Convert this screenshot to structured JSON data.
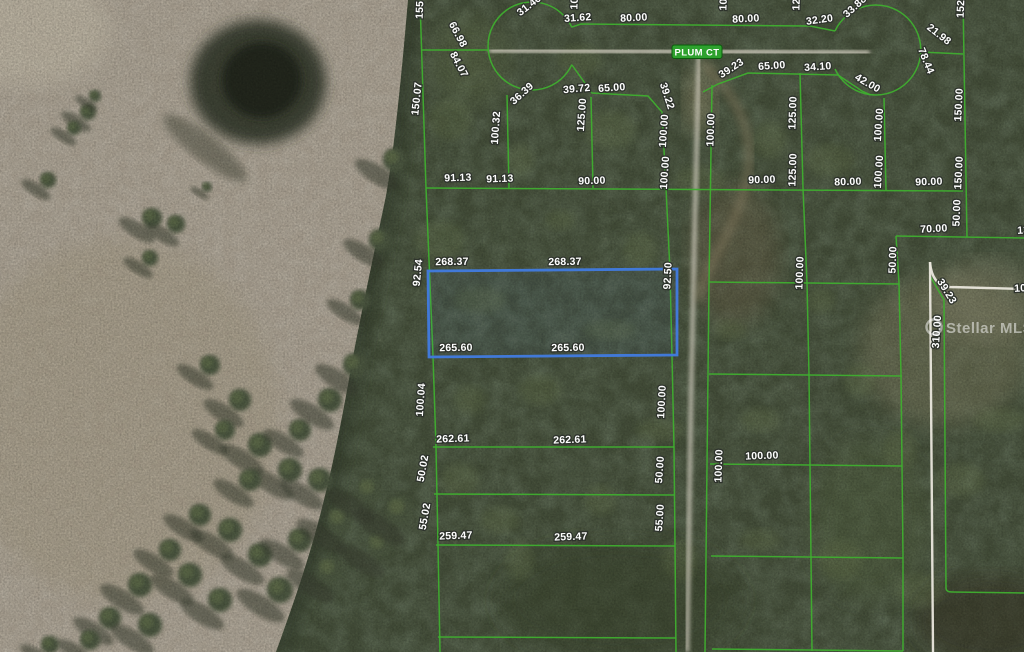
{
  "map": {
    "street_label": "PLUM CT",
    "watermark_text": "Stellar MLS",
    "colors": {
      "parcel_line": "#3fae2f",
      "highlight": "#4179d8",
      "survey_line": "#eae7dd",
      "road": "#d7d2c4",
      "badge": "#2ea12e",
      "badge_border": "#0c5c0c",
      "label_fill": "#ffffff",
      "label_halo": "#2e332c",
      "pasture": "#aaa192",
      "forest": "#454f3a"
    },
    "highlighted_parcel": {
      "top_dims": [
        "268.37",
        "268.37"
      ],
      "bottom_dims": [
        "265.60",
        "265.60"
      ],
      "left_dim": "92.54",
      "right_dim": "92.50"
    },
    "dimension_labels": [
      {
        "t": "155",
        "x": 423,
        "y": 10,
        "r": -88
      },
      {
        "t": "100.00",
        "x": 578,
        "y": -7,
        "r": -88
      },
      {
        "t": "100.00",
        "x": 727,
        "y": -6,
        "r": -88
      },
      {
        "t": "125.00",
        "x": 800,
        "y": -6,
        "r": -88
      },
      {
        "t": "152",
        "x": 964,
        "y": 9,
        "r": -88
      },
      {
        "t": "150.07",
        "x": 420,
        "y": 99,
        "r": -84
      },
      {
        "t": "92.54",
        "x": 421,
        "y": 273,
        "r": -84
      },
      {
        "t": "100.04",
        "x": 424,
        "y": 400,
        "r": -86
      },
      {
        "t": "50.02",
        "x": 426,
        "y": 469,
        "r": -80
      },
      {
        "t": "55.02",
        "x": 428,
        "y": 517,
        "r": -80
      },
      {
        "t": "66.98",
        "x": 455,
        "y": 36,
        "r": 62
      },
      {
        "t": "84.07",
        "x": 456,
        "y": 66,
        "r": 62
      },
      {
        "t": "31.46",
        "x": 531,
        "y": 8,
        "r": -38
      },
      {
        "t": "31.62",
        "x": 578,
        "y": 21,
        "r": -4
      },
      {
        "t": "80.00",
        "x": 634,
        "y": 21,
        "r": -3
      },
      {
        "t": "80.00",
        "x": 746,
        "y": 22,
        "r": -3
      },
      {
        "t": "32.20",
        "x": 820,
        "y": 23,
        "r": -8
      },
      {
        "t": "33.88",
        "x": 857,
        "y": 9,
        "r": -42
      },
      {
        "t": "36.39",
        "x": 524,
        "y": 96,
        "r": -42
      },
      {
        "t": "39.72",
        "x": 577,
        "y": 92,
        "r": -5
      },
      {
        "t": "65.00",
        "x": 612,
        "y": 91,
        "r": -4
      },
      {
        "t": "39.22",
        "x": 664,
        "y": 97,
        "r": 72
      },
      {
        "t": "100.32",
        "x": 499,
        "y": 128,
        "r": -86
      },
      {
        "t": "125.00",
        "x": 585,
        "y": 115,
        "r": -86
      },
      {
        "t": "91.13",
        "x": 458,
        "y": 181,
        "r": -2
      },
      {
        "t": "91.13",
        "x": 500,
        "y": 182,
        "r": -2
      },
      {
        "t": "90.00",
        "x": 592,
        "y": 184,
        "r": -2
      },
      {
        "t": "100.00",
        "x": 667,
        "y": 131,
        "r": -86
      },
      {
        "t": "100.00",
        "x": 668,
        "y": 173,
        "r": -86
      },
      {
        "t": "268.37",
        "x": 452,
        "y": 265,
        "r": -1
      },
      {
        "t": "268.37",
        "x": 565,
        "y": 265,
        "r": -1
      },
      {
        "t": "92.50",
        "x": 671,
        "y": 276,
        "r": -87
      },
      {
        "t": "265.60",
        "x": 456,
        "y": 351,
        "r": -1
      },
      {
        "t": "265.60",
        "x": 568,
        "y": 351,
        "r": -1
      },
      {
        "t": "262.61",
        "x": 453,
        "y": 442,
        "r": -2
      },
      {
        "t": "262.61",
        "x": 570,
        "y": 443,
        "r": -2
      },
      {
        "t": "100.00",
        "x": 665,
        "y": 402,
        "r": -87
      },
      {
        "t": "50.00",
        "x": 663,
        "y": 470,
        "r": -86
      },
      {
        "t": "55.00",
        "x": 663,
        "y": 518,
        "r": -86
      },
      {
        "t": "259.47",
        "x": 456,
        "y": 539,
        "r": -2
      },
      {
        "t": "259.47",
        "x": 571,
        "y": 540,
        "r": -2
      },
      {
        "t": "39.23",
        "x": 733,
        "y": 71,
        "r": -33
      },
      {
        "t": "65.00",
        "x": 772,
        "y": 69,
        "r": -4
      },
      {
        "t": "34.10",
        "x": 818,
        "y": 70,
        "r": -4
      },
      {
        "t": "42.00",
        "x": 866,
        "y": 86,
        "r": 30
      },
      {
        "t": "21.98",
        "x": 937,
        "y": 37,
        "r": 38
      },
      {
        "t": "78.44",
        "x": 923,
        "y": 62,
        "r": 68
      },
      {
        "t": "100.00",
        "x": 714,
        "y": 130,
        "r": -88
      },
      {
        "t": "125.00",
        "x": 796,
        "y": 113,
        "r": -88
      },
      {
        "t": "125.00",
        "x": 796,
        "y": 170,
        "r": -88
      },
      {
        "t": "100.00",
        "x": 882,
        "y": 125,
        "r": -86
      },
      {
        "t": "100.00",
        "x": 882,
        "y": 172,
        "r": -86
      },
      {
        "t": "150.00",
        "x": 962,
        "y": 105,
        "r": -87
      },
      {
        "t": "150.00",
        "x": 962,
        "y": 173,
        "r": -87
      },
      {
        "t": "90.00",
        "x": 762,
        "y": 183,
        "r": -2
      },
      {
        "t": "80.00",
        "x": 848,
        "y": 185,
        "r": -2
      },
      {
        "t": "90.00",
        "x": 929,
        "y": 185,
        "r": -2
      },
      {
        "t": "50.00",
        "x": 960,
        "y": 213,
        "r": -88
      },
      {
        "t": "70.00",
        "x": 934,
        "y": 232,
        "r": -3
      },
      {
        "t": "130.00",
        "x": 1034,
        "y": 233,
        "r": -3
      },
      {
        "t": "100.00",
        "x": 803,
        "y": 273,
        "r": -88
      },
      {
        "t": "50.00",
        "x": 896,
        "y": 260,
        "r": -88
      },
      {
        "t": "39.23",
        "x": 944,
        "y": 293,
        "r": 58
      },
      {
        "t": "310.00",
        "x": 940,
        "y": 332,
        "r": -86
      },
      {
        "t": "105.00",
        "x": 1031,
        "y": 291,
        "r": -3
      },
      {
        "t": "100.00",
        "x": 722,
        "y": 466,
        "r": -88
      },
      {
        "t": "100.00",
        "x": 762,
        "y": 459,
        "r": -2
      }
    ]
  }
}
